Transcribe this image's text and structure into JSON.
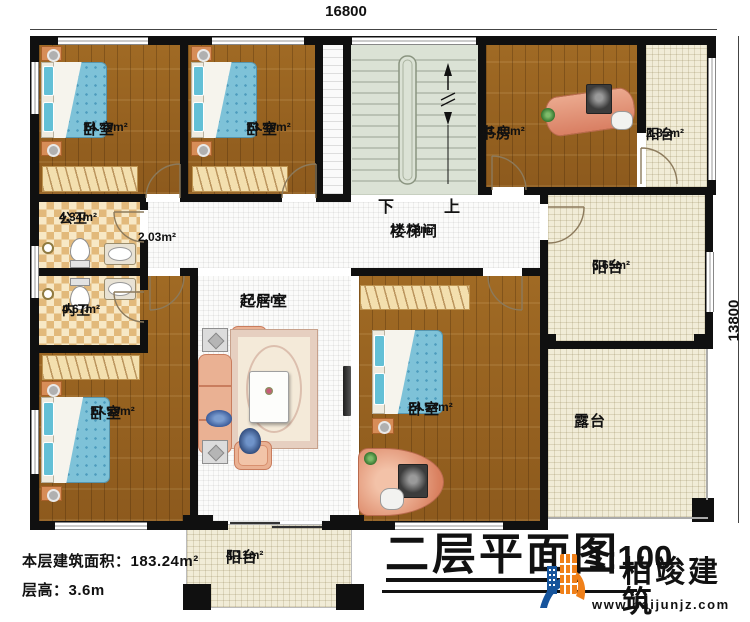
{
  "meta": {
    "drawing_title": "二层平面图",
    "scale": "1:100"
  },
  "dimensions": {
    "top": "16800",
    "right": "13800"
  },
  "footer": {
    "floor_area": "本层建筑面积：183.24m²",
    "floor_height": "层高：3.6m"
  },
  "brand": {
    "name": "柏竣建筑",
    "website": "www.baijunjz.com"
  },
  "stairs": {
    "down": "下",
    "up": "上"
  },
  "rooms": {
    "bedroom_top_left": {
      "name": "卧室",
      "area": "14.49m²"
    },
    "bedroom_top_mid": {
      "name": "卧室",
      "area": "13.40m²"
    },
    "study": {
      "name": "书房",
      "area": "13.40m²"
    },
    "balcony_top_right": {
      "name": "阳台",
      "area": "2.85m²"
    },
    "public_bath": {
      "name": "公卫",
      "area": "4.34m²"
    },
    "corridor": {
      "area": "2.03m²"
    },
    "stairwell": {
      "name": "楼梯间",
      "area": "17.78m²"
    },
    "balcony_right": {
      "name": "阳台",
      "area": "6.65m²"
    },
    "inner_bath": {
      "name": "内卫",
      "area": "4.67m²"
    },
    "living": {
      "name": "起居室",
      "area": "27.67m²"
    },
    "bedroom_bottom_left": {
      "name": "卧室",
      "area": "17.59m²"
    },
    "bedroom_bottom_right": {
      "name": "卧室",
      "area": "24.54m²"
    },
    "terrace": {
      "name": "露台"
    },
    "balcony_bottom": {
      "name": "阳台",
      "area": "4.11m²"
    }
  },
  "colors": {
    "wall": "#101010",
    "wood_floor": "#996320",
    "tile_cream": "#f1ecd7",
    "bath_checker": "#e2b97b",
    "mattress_blue": "#7ec2d8",
    "sofa_salmon": "#eab193",
    "stair_green": "#dbe2d5",
    "logo_blue": "#16549c",
    "logo_orange": "#f08019"
  }
}
